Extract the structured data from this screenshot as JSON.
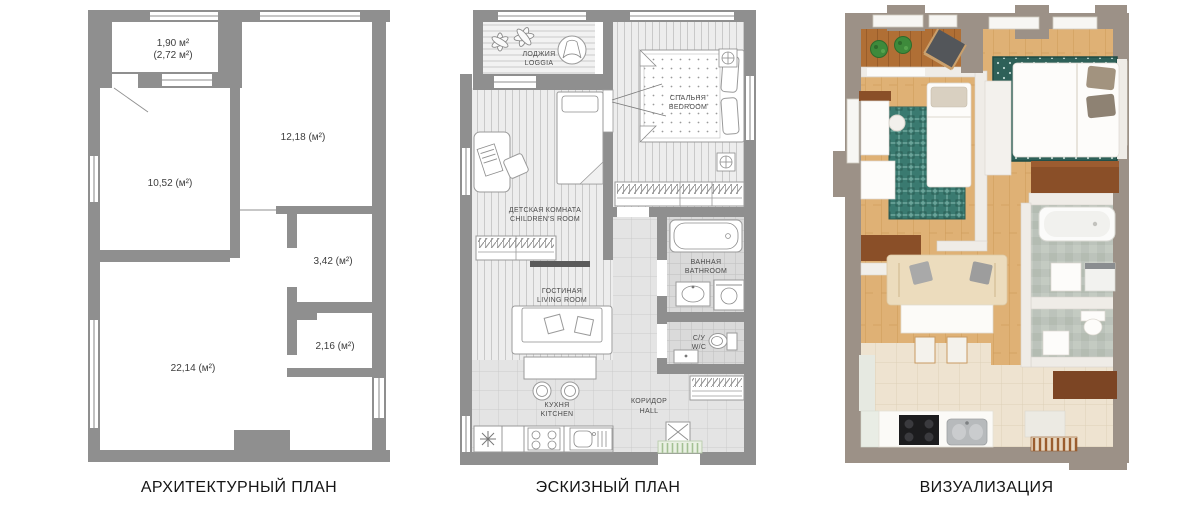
{
  "captions": {
    "plan1": "АРХИТЕКТУРНЫЙ ПЛАН",
    "plan2": "ЭСКИЗНЫЙ ПЛАН",
    "plan3": "ВИЗУАЛИЗАЦИЯ"
  },
  "architectural_plan": {
    "loggia_area": "1,90 м²",
    "loggia_area_total": "(2,72 м²)",
    "bedroom_area": "12,18 (м²)",
    "children_area": "10,52 (м²)",
    "bathroom_area": "3,42 (м²)",
    "wc_area": "2,16 (м²)",
    "living_area": "22,14 (м²)"
  },
  "sketch_plan": {
    "loggia_ru": "ЛОДЖИЯ",
    "loggia_en": "LOGGIA",
    "bedroom_ru": "СПАЛЬНЯ",
    "bedroom_en": "BEDROOM",
    "children_ru": "ДЕТСКАЯ КОМНАТА",
    "children_en": "CHILDREN'S ROOM",
    "living_ru": "ГОСТИНАЯ",
    "living_en": "LIVING ROOM",
    "bathroom_ru": "ВАННАЯ",
    "bathroom_en": "BATHROOM",
    "wc_ru": "С/У",
    "wc_en": "W/C",
    "kitchen_ru": "КУХНЯ",
    "kitchen_en": "KITCHEN",
    "hall_ru": "КОРИДОР",
    "hall_en": "HALL"
  },
  "icons": [
    "flower-icon",
    "armchair-icon",
    "double-bed-icon",
    "single-bed-icon",
    "ceiling-light-icon",
    "desk-chair-icon",
    "wardrobe-icon",
    "tv-icon",
    "sofa-icon",
    "table-stools-icon",
    "snowflake-fridge-icon",
    "stove-icon",
    "kitchen-sink-icon",
    "bathtub-icon",
    "washbasin-icon",
    "washing-machine-icon",
    "toilet-icon",
    "doormat-icon",
    "door-swing-icon",
    "plant-icon",
    "cooktop-icon",
    "dresser-icon"
  ],
  "colors": {
    "plan_wall": "#8f8f8f",
    "floor_stripe_bg": "#ededed",
    "floor_stripe_line": "#c9c9c9",
    "tile_bg": "#e4e4e4",
    "tile_line": "#cbcbcb",
    "bath_tile_bg": "#dadada",
    "bath_tile_line": "#bfbfbf",
    "label_text": "#4a4a4a",
    "area_text": "#3d3d3d",
    "render_wall": "#9c9187",
    "render_wood": "#dfb175",
    "render_deck": "#b06f35",
    "render_rug": "#3a7a70",
    "render_sofa": "#ecdcbd",
    "render_brown": "#8a4f28",
    "render_ktile": "#eee3d0",
    "render_marble": "#bcc3bb"
  }
}
